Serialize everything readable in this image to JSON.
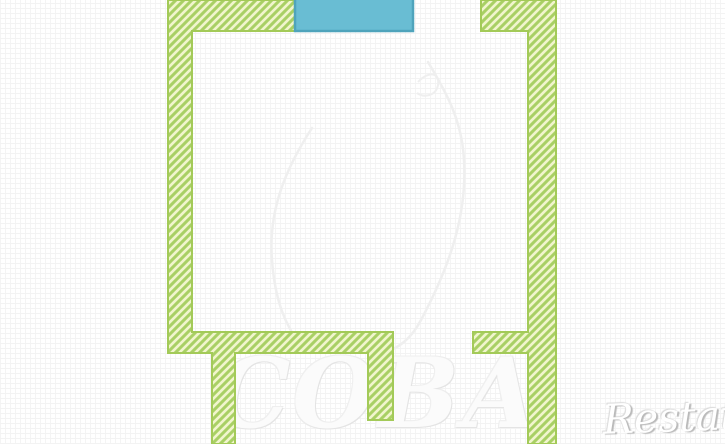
{
  "page": {
    "title": "apartment floor plan"
  },
  "watermarks": {
    "center_logo_text": "СОВА",
    "brand_text": "Restate"
  },
  "colors": {
    "background": "#ffffff",
    "grid_line": "#f3f3f3",
    "wall_hatch_bg": "#f1f5cd",
    "wall_hatch_stripe": "#a9d065",
    "wall_border": "#a3ca58",
    "balcony_fill": "#69bdd3",
    "balcony_border": "#4fa4bc",
    "owl_outline": "#efefef",
    "watermark_text_gray": "#e4e4e4",
    "brand_text_shadow": "#b9b9b9"
  }
}
